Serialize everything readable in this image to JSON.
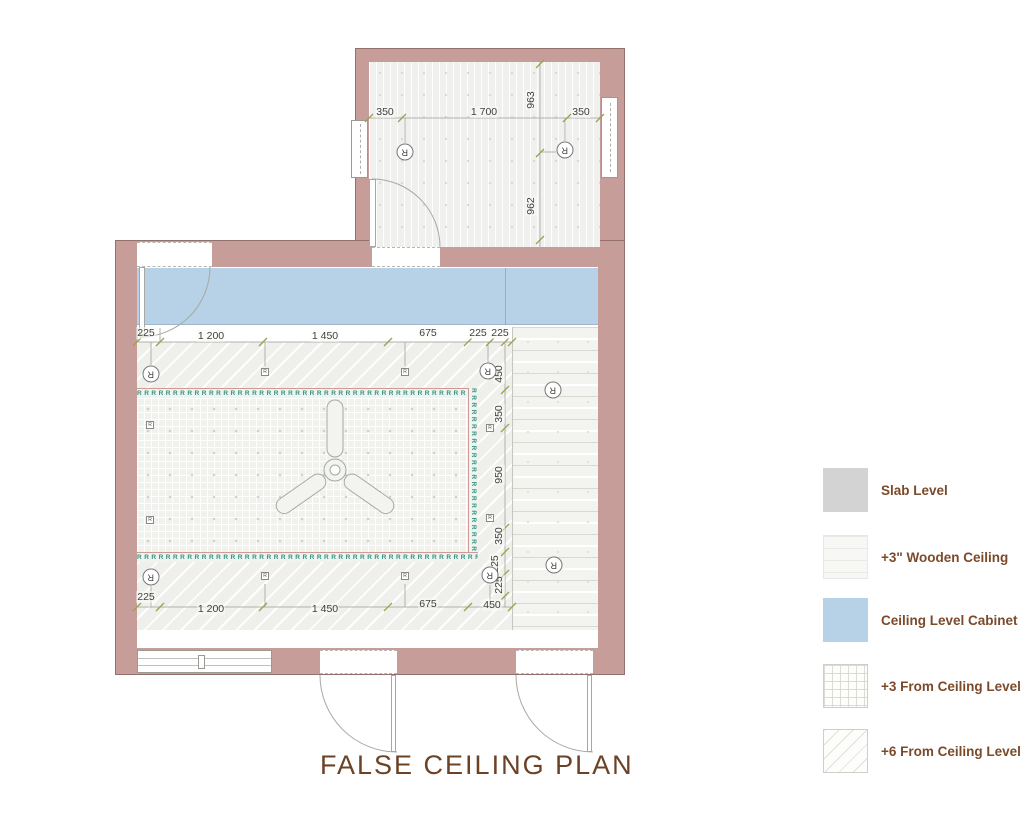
{
  "title": "FALSE CEILING PLAN",
  "legend": {
    "items": [
      {
        "label": "Slab Level"
      },
      {
        "label": "+3\"  Wooden Ceiling"
      },
      {
        "label": "Ceiling Level Cabinet"
      },
      {
        "label": "+3 From Ceiling Level"
      },
      {
        "label": "+6 From Ceiling Level"
      }
    ]
  },
  "colors": {
    "wall": "#c69d98",
    "wall_border": "#92716c",
    "cabinet": "#b7d2e6",
    "cabinet_border": "#9db8cc",
    "slab": "#d3d3d3",
    "dim_line": "#b2b2ac",
    "tick": "#a0a052",
    "dim_text": "#3f3f3f",
    "rope": "#35907c",
    "rope_edge": "#cf9a93",
    "legend_text": "#7b4a2b",
    "title_text": "#6b4226"
  },
  "rope_light": {
    "glyph": "R"
  },
  "markers": {
    "circled_glyph": "R",
    "square_glyph": "R",
    "circled": [
      {
        "x": 405,
        "y": 152
      },
      {
        "x": 565,
        "y": 150
      },
      {
        "x": 151,
        "y": 374
      },
      {
        "x": 488,
        "y": 371
      },
      {
        "x": 151,
        "y": 577
      },
      {
        "x": 490,
        "y": 575
      },
      {
        "x": 553,
        "y": 390
      },
      {
        "x": 554,
        "y": 565
      }
    ],
    "squares": [
      {
        "x": 265,
        "y": 372
      },
      {
        "x": 405,
        "y": 372
      },
      {
        "x": 150,
        "y": 425
      },
      {
        "x": 150,
        "y": 520
      },
      {
        "x": 490,
        "y": 428
      },
      {
        "x": 490,
        "y": 518
      },
      {
        "x": 265,
        "y": 576
      },
      {
        "x": 405,
        "y": 576
      }
    ]
  },
  "dimensions": {
    "labels": [
      {
        "t": "350",
        "x": 385,
        "y": 112
      },
      {
        "t": "1 700",
        "x": 484,
        "y": 112
      },
      {
        "t": "350",
        "x": 581,
        "y": 112
      },
      {
        "t": "963",
        "x": 531,
        "y": 100,
        "r": -90
      },
      {
        "t": "962",
        "x": 531,
        "y": 206,
        "r": -90
      },
      {
        "t": "225",
        "x": 146,
        "y": 333
      },
      {
        "t": "1 200",
        "x": 211,
        "y": 336
      },
      {
        "t": "1 450",
        "x": 325,
        "y": 336
      },
      {
        "t": "675",
        "x": 428,
        "y": 333
      },
      {
        "t": "225",
        "x": 478,
        "y": 333
      },
      {
        "t": "225",
        "x": 500,
        "y": 333
      },
      {
        "t": "225",
        "x": 146,
        "y": 597
      },
      {
        "t": "1 200",
        "x": 211,
        "y": 609
      },
      {
        "t": "1 450",
        "x": 325,
        "y": 609
      },
      {
        "t": "675",
        "x": 428,
        "y": 604
      },
      {
        "t": "450",
        "x": 492,
        "y": 605
      },
      {
        "t": "450",
        "x": 499,
        "y": 374,
        "r": -90
      },
      {
        "t": "350",
        "x": 499,
        "y": 414,
        "r": -90
      },
      {
        "t": "950",
        "x": 499,
        "y": 475,
        "r": -90
      },
      {
        "t": "350",
        "x": 499,
        "y": 536,
        "r": -90
      },
      {
        "t": "225",
        "x": 495,
        "y": 564,
        "r": -90
      },
      {
        "t": "225",
        "x": 499,
        "y": 585,
        "r": -90
      }
    ],
    "lines": [
      [
        369,
        118,
        600,
        118
      ],
      [
        540,
        62,
        540,
        247
      ],
      [
        405,
        118,
        405,
        143
      ],
      [
        565,
        118,
        565,
        141
      ],
      [
        540,
        152,
        556,
        152
      ],
      [
        137,
        342,
        512,
        342
      ],
      [
        137,
        607,
        512,
        607
      ],
      [
        505,
        342,
        505,
        607
      ],
      [
        151,
        342,
        151,
        365
      ],
      [
        265,
        342,
        265,
        366
      ],
      [
        405,
        342,
        405,
        366
      ],
      [
        488,
        342,
        488,
        362
      ],
      [
        151,
        586,
        151,
        607
      ],
      [
        265,
        584,
        265,
        607
      ],
      [
        405,
        584,
        405,
        607
      ],
      [
        490,
        585,
        490,
        607
      ],
      [
        137,
        328,
        137,
        342
      ],
      [
        160,
        328,
        160,
        342
      ]
    ],
    "ticks": [
      [
        369,
        118
      ],
      [
        402,
        118
      ],
      [
        567,
        118
      ],
      [
        600,
        118
      ],
      [
        540,
        64
      ],
      [
        540,
        153
      ],
      [
        540,
        240
      ],
      [
        137,
        342
      ],
      [
        160,
        342
      ],
      [
        263,
        342
      ],
      [
        388,
        342
      ],
      [
        468,
        342
      ],
      [
        490,
        342
      ],
      [
        512,
        342
      ],
      [
        137,
        607
      ],
      [
        160,
        607
      ],
      [
        263,
        607
      ],
      [
        388,
        607
      ],
      [
        468,
        607
      ],
      [
        512,
        607
      ],
      [
        505,
        342
      ],
      [
        505,
        390
      ],
      [
        505,
        428
      ],
      [
        505,
        528
      ],
      [
        505,
        552
      ],
      [
        505,
        574
      ],
      [
        505,
        596
      ]
    ]
  }
}
